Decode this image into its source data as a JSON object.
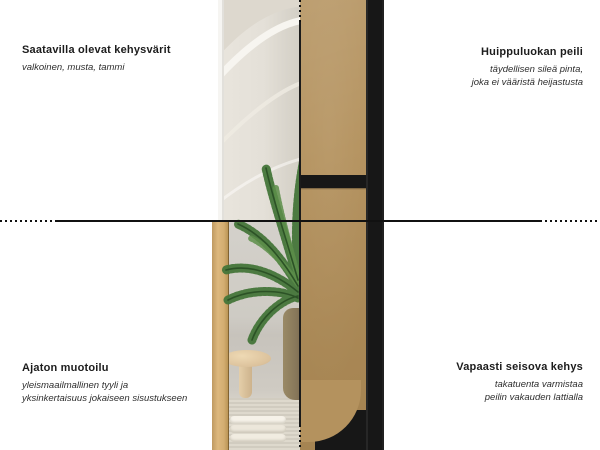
{
  "colors": {
    "bg": "#ffffff",
    "line": "#111111",
    "mdf": "#b4925e",
    "frame_black": "#171717",
    "oak": "#d4a96e",
    "plant": "#3e6d33",
    "wall_cream": "#e7e3db",
    "wall_gray": "#d2cfc9",
    "text_dark": "#1c1c1c",
    "text_sub": "#2e2e2e"
  },
  "annotations": {
    "top_left": {
      "title": "Saatavilla olevat kehysvärit",
      "lines": [
        "valkoinen, musta, tammi"
      ]
    },
    "top_right": {
      "title": "Huippuluokan peili",
      "lines": [
        "täydellisen sileä pinta,",
        "joka ei vääristä heijastusta"
      ]
    },
    "bottom_left": {
      "title": "Ajaton muotoilu",
      "lines": [
        "yleismaailmallinen tyyli ja",
        "yksinkertaisuus jokaiseen sisustukseen"
      ]
    },
    "bottom_right": {
      "title": "Vapaasti seisova kehys",
      "lines": [
        "takatuenta varmistaa",
        "peilin vakauden lattialla"
      ]
    }
  }
}
